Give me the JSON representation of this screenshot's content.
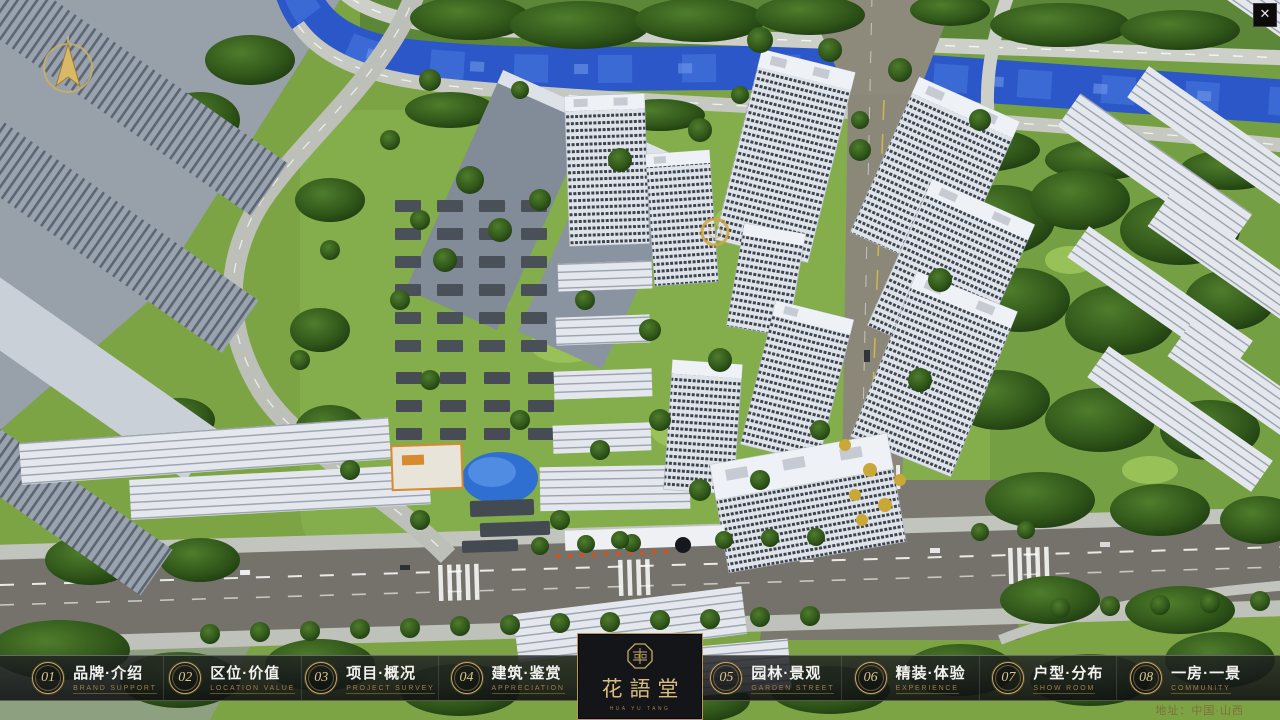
{
  "window": {
    "close_glyph": "✕"
  },
  "nav": {
    "items": [
      {
        "num": "01",
        "zh": "品牌·介绍",
        "en": "BRAND SUPPORT"
      },
      {
        "num": "02",
        "zh": "区位·价值",
        "en": "LOCATION VALUE"
      },
      {
        "num": "03",
        "zh": "项目·概况",
        "en": "PROJECT SURVEY"
      },
      {
        "num": "04",
        "zh": "建筑·鉴赏",
        "en": "APPRECIATION"
      },
      {
        "num": "05",
        "zh": "园林·景观",
        "en": "GARDEN STREET"
      },
      {
        "num": "06",
        "zh": "精装·体验",
        "en": "EXPERIENCE"
      },
      {
        "num": "07",
        "zh": "户型·分布",
        "en": "SHOW ROOM"
      },
      {
        "num": "08",
        "zh": "一房·一景",
        "en": "COMMUNITY"
      }
    ],
    "logo": {
      "title": "花語堂",
      "subtitle": "HUA YU TANG"
    }
  },
  "footer": {
    "address": "地址：中国·山西"
  },
  "palette": {
    "accent_gold": "#c9a96a",
    "gold_dark": "#8a7340",
    "bar_bg": "#1a1c1f",
    "river_blue": "#2b57c8",
    "tree_green": "#2f5519",
    "grass_green": "#84ad4b",
    "road_gray": "#7b786f",
    "building_white": "#e7eaf0",
    "slab_gray": "#99a3af"
  }
}
